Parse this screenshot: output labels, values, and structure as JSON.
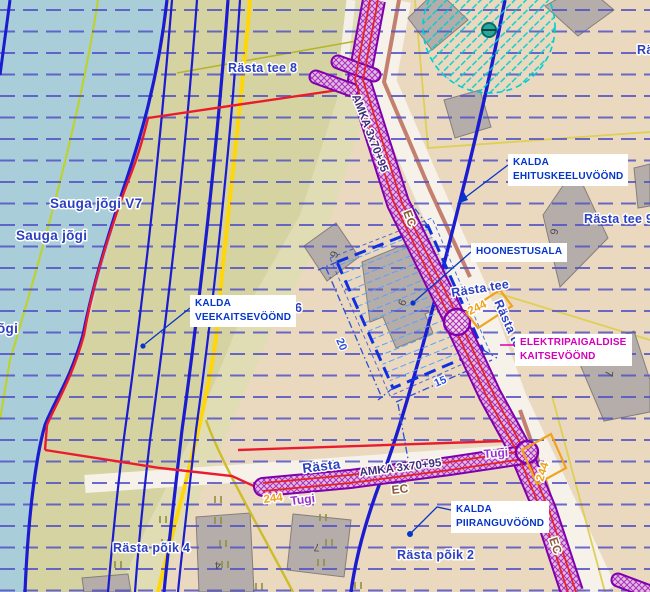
{
  "labels": {
    "streets": {
      "rasta_tee_8": "Rästa tee 8",
      "rasta_tee_9": "Rästa tee 9",
      "rasta_tee_6_partial": "e 6",
      "rasta_tee_road_h": "Rästa tee",
      "rasta_tee_road_v": "Rästa tee",
      "rasta_bottom": "Rästa",
      "rasta_partial_right": "Rä",
      "rasta_poik_4": "Rästa põik 4",
      "rasta_poik_2": "Rästa põik 2",
      "sauga_jogi_v": "Sauga jõgi V7",
      "sauga_jogi": "Sauga jõgi",
      "jogi_partial": "õgi"
    },
    "infrastructure": {
      "power_line": "AMKA 3x70+95",
      "ec": "EC",
      "pole": "Tugi",
      "pole_number": "244"
    },
    "dimensions": {
      "width_20": "20",
      "length_15": "15"
    },
    "building_numbers": {
      "b6a": "6",
      "b9": "9",
      "b6b": "6",
      "b7a": "7",
      "b4": "4",
      "b7b": "7"
    }
  },
  "callouts": {
    "veekaitse": {
      "line1": "KALDA",
      "line2": "VEEKAITSEVÖÖND"
    },
    "ehituskeeld": {
      "line1": "KALDA",
      "line2": "EHITUSKEELUVÖÖND"
    },
    "hoonestusala": {
      "line1": "HOONESTUSALA"
    },
    "elektri": {
      "line1": "ELEKTRIPAIGALDISE",
      "line2": "KAITSEVÖÖND"
    },
    "piirang": {
      "line1": "KALDA",
      "line2": "PIIRANGUVÖÖND"
    }
  },
  "colors": {
    "water": "#aacdda",
    "land_khaki": "#d5d3a2",
    "land_khaki_pale": "#e0dcb4",
    "land_beige": "#ead9bf",
    "road_white": "#f6f2ea",
    "road_salmon": "#c4806f",
    "grid_dash_blue": "#5252c6",
    "contour_blue": "#1b1bd0",
    "boundary_red": "#ea1b2e",
    "road_yellow": "#ffd60a",
    "parcel_yellow": "#decf55",
    "chartreuse": "#bdd22f",
    "corridor_purple": "#7f00ad",
    "corridor_hatch": "#aa30b8",
    "cable_red": "#e82020",
    "protection_cyan": "#00cfcf",
    "well_teal": "#2aa79b",
    "hoonestusala_blue": "#0f2fe0",
    "street_label_blue": "#2b3fc0",
    "pole_number_orange": "#f0a01c",
    "tugi_purple": "#9933cc",
    "ec_brown": "#8a5a35",
    "amka_indigo": "#3f2d7d",
    "building_gray": "#b4adaa",
    "callout_blue": "#0536c8",
    "callout_magenta": "#d400b8"
  }
}
